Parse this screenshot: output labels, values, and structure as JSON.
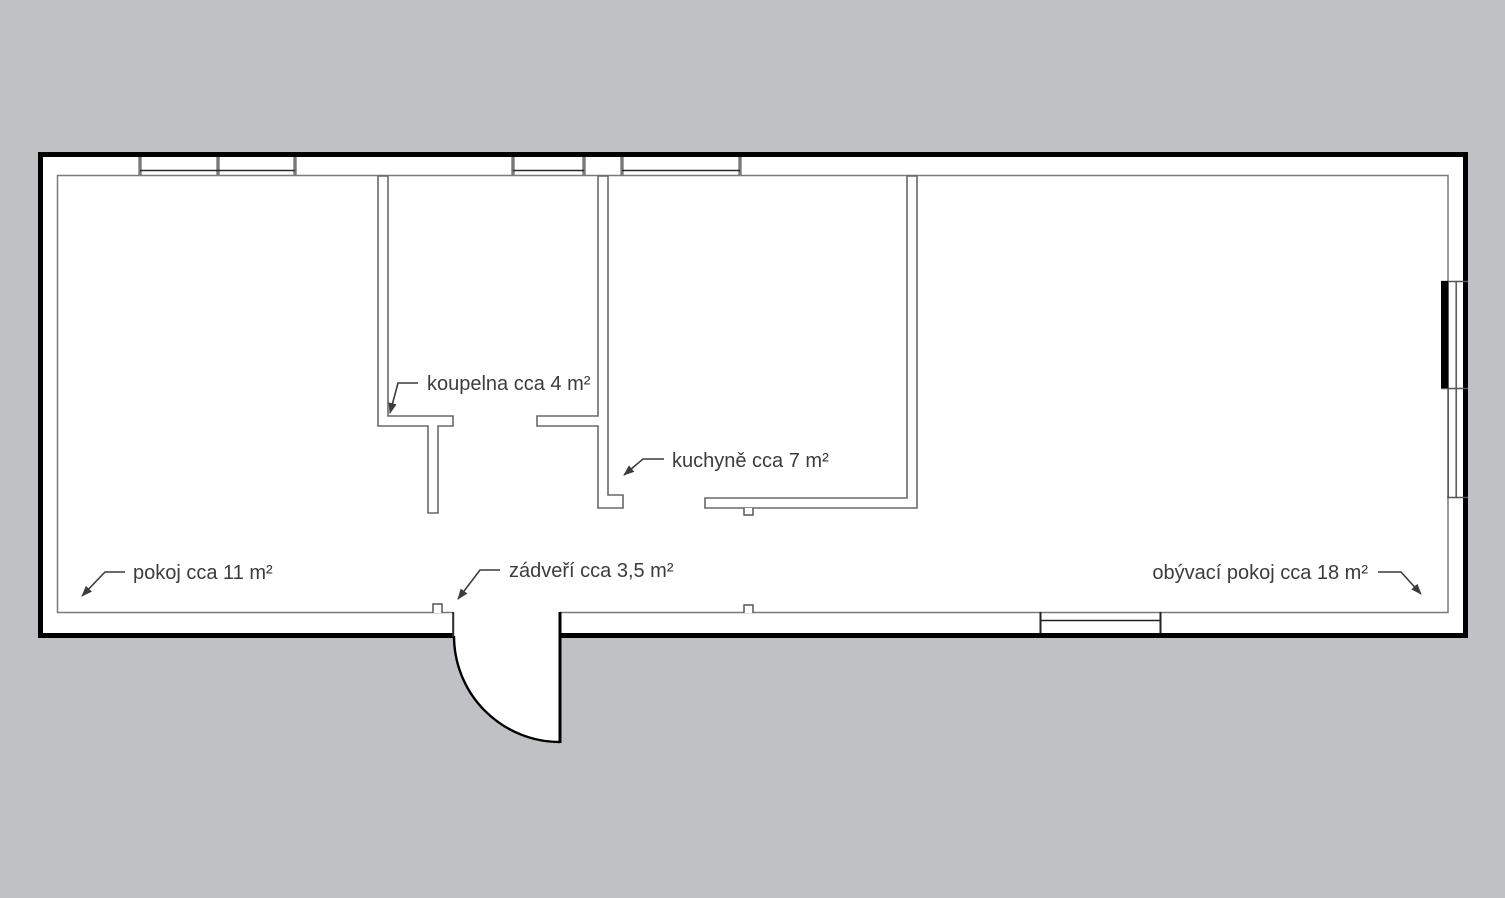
{
  "drawing": {
    "type": "floor-plan",
    "background_color": "#c0c1c5",
    "floor_color": "#ffffff",
    "exterior_wall_color": "#000000",
    "interior_wall_color": "#686868",
    "label_color": "#3c3c3c"
  },
  "rooms": [
    {
      "id": "koupelna",
      "label": "koupelna cca 4 m²"
    },
    {
      "id": "kuchyne",
      "label": "kuchyně cca 7 m²"
    },
    {
      "id": "pokoj",
      "label": "pokoj cca 11 m²"
    },
    {
      "id": "zadveri",
      "label": "zádveří cca 3,5 m²"
    },
    {
      "id": "obyvaci",
      "label": "obývací pokoj cca 18 m²"
    }
  ]
}
